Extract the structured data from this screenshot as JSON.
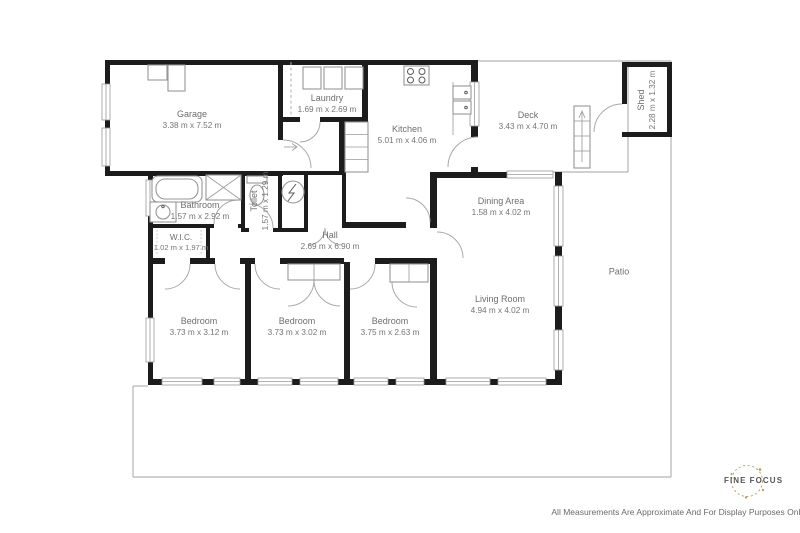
{
  "rooms": {
    "garage": {
      "name": "Garage",
      "dims": "3.38 m x 7.52 m"
    },
    "laundry": {
      "name": "Laundry",
      "dims": "1.69 m x 2.69 m"
    },
    "kitchen": {
      "name": "Kitchen",
      "dims": "5.01 m x 4.06 m"
    },
    "deck": {
      "name": "Deck",
      "dims": "3.43 m x 4.70 m"
    },
    "shed": {
      "name": "Shed",
      "dims": "2.28 m x 1.32 m"
    },
    "bathroom": {
      "name": "Bathroom",
      "dims": "1.57 m x 2.92 m"
    },
    "toilet": {
      "name": "Toilet",
      "dims": "1.57 m x 1.29 m"
    },
    "wic": {
      "name": "W.I.C.",
      "dims": "1.02 m x 1.97 m"
    },
    "hall": {
      "name": "Hall",
      "dims": "2.69 m x 6.90 m"
    },
    "dining_area": {
      "name": "Dining Area",
      "dims": "1.58 m x 4.02 m"
    },
    "living_room": {
      "name": "Living Room",
      "dims": "4.94 m x 4.02 m"
    },
    "patio": {
      "name": "Patio",
      "dims": ""
    },
    "bedroom_1": {
      "name": "Bedroom",
      "dims": "3.73 m x 3.12 m"
    },
    "bedroom_2": {
      "name": "Bedroom",
      "dims": "3.73 m x 3.02 m"
    },
    "bedroom_3": {
      "name": "Bedroom",
      "dims": "3.75 m x 2.63 m"
    }
  },
  "logo": {
    "fine": "FINE",
    "focus": "FOCUS",
    "accent": "#b8935a"
  },
  "footer": {
    "disclaimer": "All Measurements Are Approximate And For Display Purposes Only"
  },
  "colors": {
    "wall": "#1c1c1c",
    "thin_line": "#b3b3b3",
    "label": "#6e6e6e"
  }
}
